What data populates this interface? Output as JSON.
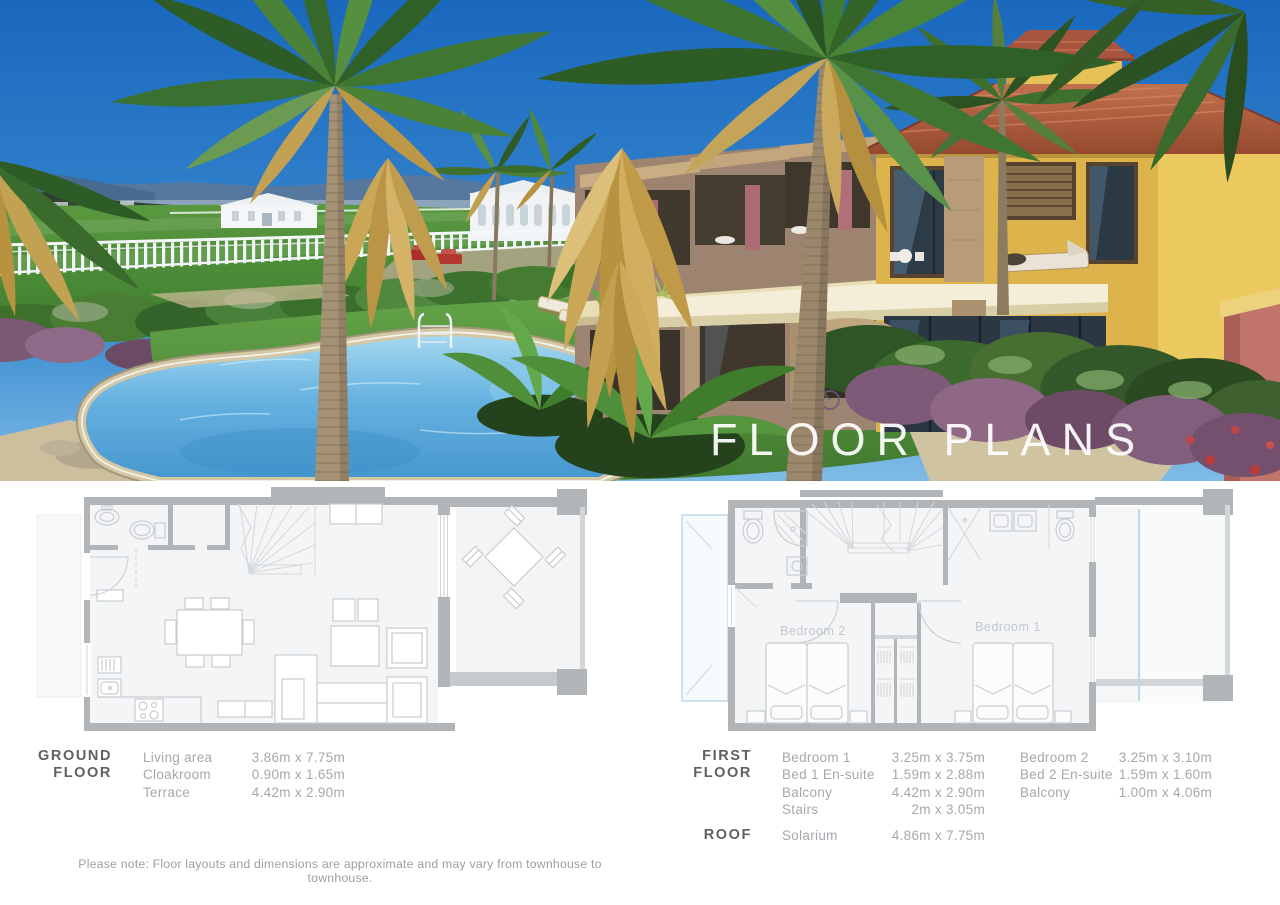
{
  "hero": {
    "overlay_title": "FLOOR PLANS",
    "scene": "3D render of yellow two-storey townhouses with terracotta roofs, palm trees, kidney-shaped pool, lawn, white fence, marquees and mountains",
    "colors": {
      "sky": "#1f6fc2",
      "pool_water": "#4a9fd9",
      "pool_coping": "#d5caa8",
      "house_wall": "#ddb44c",
      "roof": "#a85540",
      "grass": "#4c8c36",
      "plan_wall": "#b2b5b8",
      "plan_balcony_glass": "#b9d6e6"
    }
  },
  "plans": {
    "ground": {
      "heading": [
        "GROUND",
        "FLOOR"
      ],
      "rows": [
        {
          "label": "Living area",
          "value": "3.86m x 7.75m"
        },
        {
          "label": "Cloakroom",
          "value": "0.90m x 1.65m"
        },
        {
          "label": "Terrace",
          "value": "4.42m x 2.90m"
        }
      ]
    },
    "first": {
      "heading": [
        "FIRST",
        "FLOOR"
      ],
      "col1": [
        {
          "label": "Bedroom 1",
          "value": "3.25m x 3.75m"
        },
        {
          "label": "Bed 1 En-suite",
          "value": "1.59m x 2.88m"
        },
        {
          "label": "Balcony",
          "value": "4.42m x 2.90m"
        },
        {
          "label": "Stairs",
          "value": "2m x 3.05m"
        }
      ],
      "col2": [
        {
          "label": "Bedroom 2",
          "value": "3.25m x 3.10m"
        },
        {
          "label": "Bed 2 En-suite",
          "value": "1.59m x 1.60m"
        },
        {
          "label": "Balcony",
          "value": "1.00m x 4.06m"
        }
      ],
      "room_labels": {
        "bedroom2": "Bedroom 2",
        "bedroom1": "Bedroom 1"
      }
    },
    "roof": {
      "heading": "ROOF",
      "rows": [
        {
          "label": "Solarium",
          "value": "4.86m x 7.75m"
        }
      ]
    }
  },
  "note": "Please note: Floor layouts and dimensions are approximate and may vary from townhouse to townhouse."
}
